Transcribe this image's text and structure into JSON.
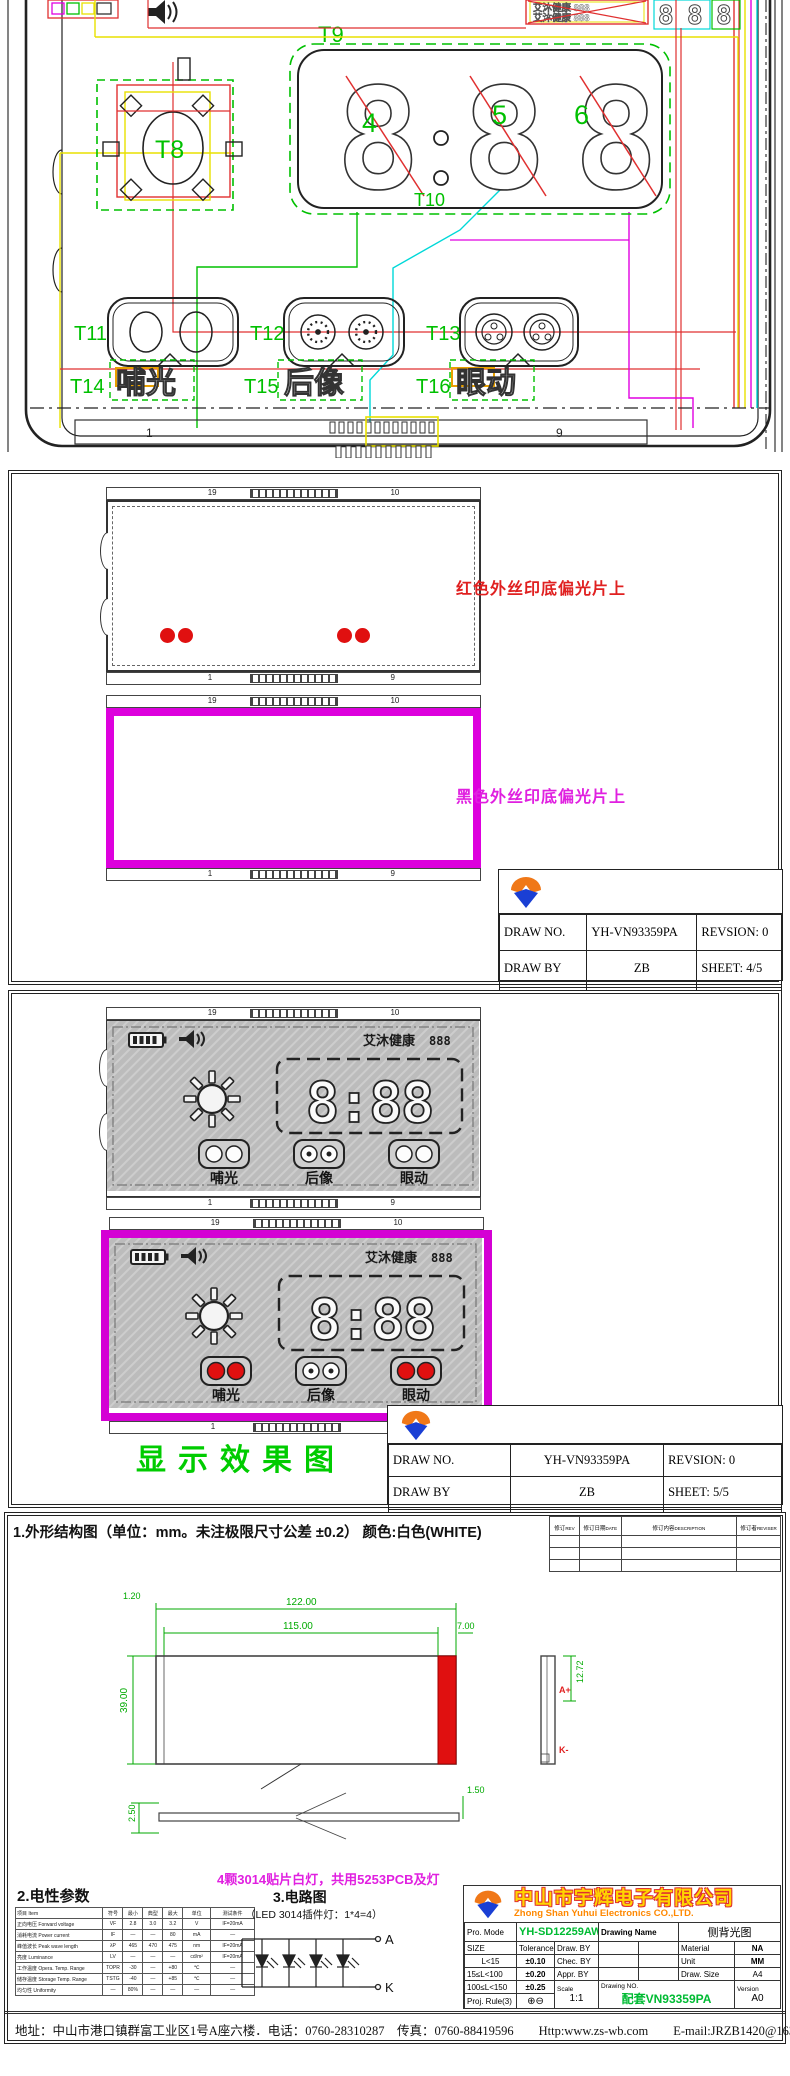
{
  "colors": {
    "accent_green": "#00c000",
    "wire_red": "#e03030",
    "wire_yellow": "#e8e000",
    "wire_cyan": "#00d8d8",
    "wire_magenta": "#e000e0",
    "note_red": "#e02020",
    "note_magenta": "#e020e0",
    "led_red": "#e01010",
    "caption_green": "#00cc00"
  },
  "title_block": {
    "draw_no_label": "DRAW NO.",
    "draw_no": "YH-VN93359PA",
    "revision_label": "REVSION:",
    "revision": "0",
    "draw_by_label": "DRAW BY",
    "draw_by": "ZB",
    "checked_by_label": "CHECKED BY",
    "checked_by": "ZB",
    "sheet_label_4": "SHEET: 4/5",
    "sheet_label_5": "SHEET: 5/5",
    "date_label": "DATE: 9/08/2021"
  },
  "panel1": {
    "t8": "T8",
    "t9": "T9",
    "t10": "T10",
    "t11": "T11",
    "t12": "T12",
    "t13": "T13",
    "t14": "T14",
    "t15": "T15",
    "t16": "T16",
    "digit4": "4",
    "digit5": "5",
    "digit6": "6",
    "seg8": "8",
    "btn_buguang": "哺光",
    "btn_houxiang": "后像",
    "btn_yandong": "眼动",
    "brand_line1": "艾沐健康 888",
    "brand_line2": "艾沐健康 888",
    "scale_left": "1",
    "scale_right": "9"
  },
  "panel2": {
    "red_note": "红色外丝印底偏光片上",
    "black_note": "黑色外丝印底偏光片上",
    "tick_tl": "19",
    "tick_tr": "10",
    "tick_bl": "1",
    "tick_br": "9"
  },
  "panel3": {
    "caption": "显示效果图",
    "lcd": {
      "brand": "艾沐健康",
      "brand_digits": "888",
      "time": "8:88",
      "btn1": "哺光",
      "btn2": "后像",
      "btn3": "眼动",
      "tick_tl": "19",
      "tick_tr": "10",
      "tick_bl": "1",
      "tick_br": "9"
    }
  },
  "panel4": {
    "heading": "1.外形结构图（单位：mm。未注极限尺寸公差 ±0.2）  颜色:白色(WHITE)",
    "revision_table": {
      "cols": [
        {
          "cn": "修订",
          "en": "REV"
        },
        {
          "cn": "修订日期",
          "en": "DATE"
        },
        {
          "cn": "修订内容",
          "en": "DESCRIPTION"
        },
        {
          "cn": "修订者",
          "en": "REVISER"
        }
      ]
    },
    "dims": {
      "total_width": "122.00",
      "inner_width": "115.00",
      "left_margin": "1.20",
      "right_bar": "7.00",
      "height": "39.00",
      "side_height": "12.72",
      "profile_left": "2.50",
      "profile_right": "1.50",
      "anode": "A+",
      "cathode": "K-"
    },
    "magenta_note": "4颗3014贴片白灯，共用5253PCB及灯",
    "elec_heading": "2.电性参数",
    "elec_table": {
      "headers": [
        "项目 Item",
        "符号",
        "最小",
        "典型",
        "最大",
        "单位",
        "测试条件"
      ],
      "rows": [
        [
          "正向电压 Forward voltage",
          "VF",
          "2.8",
          "3.0",
          "3.2",
          "V",
          "IF=20mA"
        ],
        [
          "消耗电流 Power current",
          "IF",
          "—",
          "—",
          "80",
          "mA",
          "—"
        ],
        [
          "峰值波长 Peak wave length",
          "λP",
          "465",
          "470",
          "475",
          "nm",
          "IF=20mA"
        ],
        [
          "亮度 Luminance",
          "LV",
          "—",
          "—",
          "—",
          "cd/m²",
          "IF=20mA"
        ],
        [
          "工作温度 Opera. Temp. Range",
          "TOPR",
          "-30",
          "—",
          "+80",
          "℃",
          "—"
        ],
        [
          "储存温度 Storage Temp. Range",
          "TSTG",
          "-40",
          "—",
          "+85",
          "℃",
          "—"
        ],
        [
          "均匀性 Uniformity",
          "—",
          "80%",
          "—",
          "—",
          "—",
          "—"
        ]
      ]
    },
    "circuit_heading": "3.电路图",
    "circuit_sub": "（LED 3014插件灯：1*4=4）",
    "terminal_a": "A",
    "terminal_k": "K",
    "company": {
      "name_cn": "中山市宇辉电子有限公司",
      "name_en": "Zhong Shan Yuhui Electronics CO.,LTD.",
      "pro_mode_label": "Pro. Mode",
      "pro_mode": "YH-SD12259AW4",
      "drawing_name_label": "Drawing Name",
      "drawing_name": "侧背光图",
      "size_label": "SIZE",
      "tolerance_label": "Tolerance",
      "tol1_label": "L<15",
      "tol1": "±0.10",
      "tol2_label": "15≤L<100",
      "tol2": "±0.20",
      "tol3_label": "100≤L<150",
      "tol3": "±0.25",
      "draw_by_label": "Draw. BY",
      "chec_by_label": "Chec. BY",
      "appr_by_label": "Appr. BY",
      "material_label": "Material",
      "material": "NA",
      "unit_label": "Unit",
      "unit": "MM",
      "draw_size_label": "Draw. Size",
      "draw_size": "A4",
      "scale_label": "Scale",
      "scale": "1:1",
      "proj_rule_label": "Proj. Rule(3)",
      "proj_symbol": "⊕⊖",
      "drawing_no_label": "Drawing NO.",
      "drawing_no": "配套VN93359PA",
      "version_label": "Version",
      "version": "A0"
    },
    "footer": "地址：中山市港口镇群富工业区1号A座六楼．电话：0760-28310287　传真：0760-88419596　　Http:www.zs-wb.com　　E-mail:JRZB1420@163.com"
  }
}
